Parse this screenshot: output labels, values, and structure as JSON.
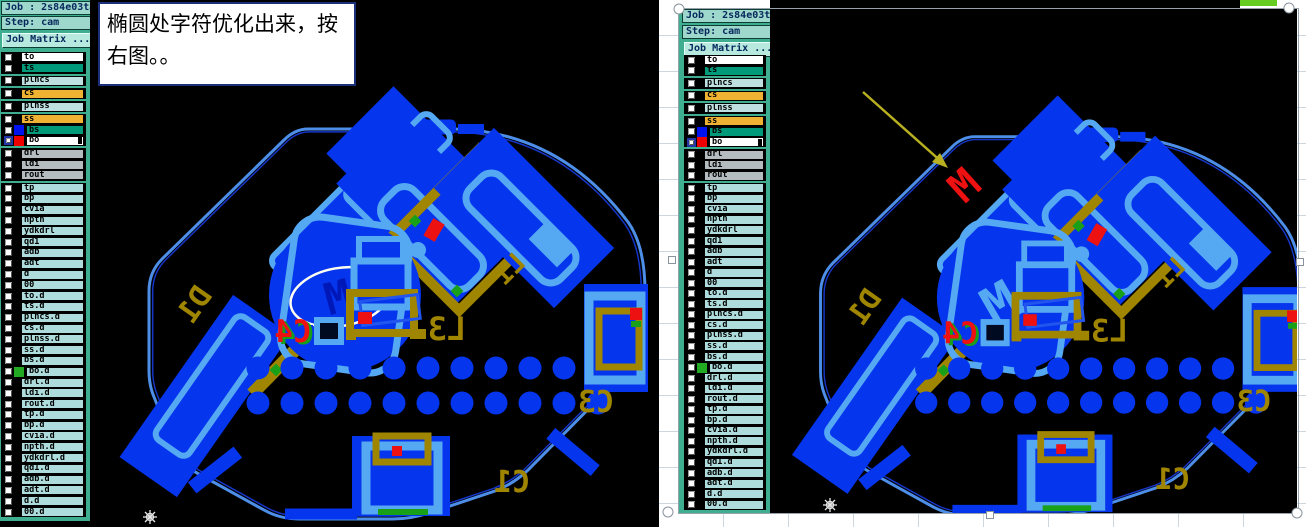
{
  "app": {
    "job_label": "Job : 2s84e03ta0",
    "step_label": "Step: cam",
    "matrix_button": "Job Matrix ..."
  },
  "annotation": {
    "text": "椭圆处字符优化出来，按右图。。"
  },
  "layers": [
    {
      "name": "to",
      "bg": "#ffffff"
    },
    {
      "name": "ts",
      "bg": "#00997a"
    },
    {
      "name": "plncs",
      "bg": "#bfe0e0",
      "gap": true
    },
    {
      "name": "cs",
      "bg": "#f0b233",
      "gap": true
    },
    {
      "name": "plnss",
      "bg": "#bfe0e0",
      "gap": true
    },
    {
      "name": "ss",
      "bg": "#f0b233",
      "gap": true
    },
    {
      "name": "bs",
      "bg": "#00997a",
      "chip": "#0013ee"
    },
    {
      "name": "bo",
      "bg": "#ffffff",
      "chip": "#ee0000",
      "selected": true,
      "notch": true
    },
    {
      "name": "drl",
      "bg": "#b4bcc0",
      "gap": true
    },
    {
      "name": "ldi",
      "bg": "#b4bcc0"
    },
    {
      "name": "rout",
      "bg": "#b4bcc0"
    },
    {
      "name": "tp",
      "bg": "#aedcdc",
      "gap": true
    },
    {
      "name": "bp",
      "bg": "#aedcdc"
    },
    {
      "name": "cvia",
      "bg": "#aedcdc"
    },
    {
      "name": "npth",
      "bg": "#aedcdc"
    },
    {
      "name": "ydkdrl",
      "bg": "#aedcdc"
    },
    {
      "name": "qd1",
      "bg": "#aedcdc"
    },
    {
      "name": "adb",
      "bg": "#aedcdc"
    },
    {
      "name": "adt",
      "bg": "#aedcdc"
    },
    {
      "name": "d",
      "bg": "#aedcdc"
    },
    {
      "name": "00",
      "bg": "#aedcdc"
    },
    {
      "name": "to.d",
      "bg": "#aedcdc"
    },
    {
      "name": "ts.d",
      "bg": "#aedcdc"
    },
    {
      "name": "plncs.d",
      "bg": "#aedcdc"
    },
    {
      "name": "cs.d",
      "bg": "#aedcdc"
    },
    {
      "name": "plnss.d",
      "bg": "#aedcdc"
    },
    {
      "name": "ss.d",
      "bg": "#aedcdc"
    },
    {
      "name": "bs.d",
      "bg": "#aedcdc"
    },
    {
      "name": "bo.d",
      "bg": "#aedcdc",
      "chip": "#22aa22"
    },
    {
      "name": "drl.d",
      "bg": "#aedcdc"
    },
    {
      "name": "ldi.d",
      "bg": "#aedcdc"
    },
    {
      "name": "rout.d",
      "bg": "#aedcdc"
    },
    {
      "name": "tp.d",
      "bg": "#aedcdc"
    },
    {
      "name": "bp.d",
      "bg": "#aedcdc"
    },
    {
      "name": "cvia.d",
      "bg": "#aedcdc"
    },
    {
      "name": "npth.d",
      "bg": "#aedcdc"
    },
    {
      "name": "ydkdrl.d",
      "bg": "#aedcdc"
    },
    {
      "name": "qd1.d",
      "bg": "#aedcdc"
    },
    {
      "name": "adb.d",
      "bg": "#aedcdc"
    },
    {
      "name": "adt.d",
      "bg": "#aedcdc"
    },
    {
      "name": "d.d",
      "bg": "#aedcdc"
    },
    {
      "name": "00.d",
      "bg": "#aedcdc"
    }
  ],
  "board": {
    "labels": {
      "d1": "D1",
      "c4": "C4",
      "l3": "L3",
      "l1": "L1",
      "c3": "C3",
      "c1": "C1"
    },
    "motor_char": "M",
    "moved_char": "M",
    "dot_rows": 2,
    "dots_per_row": 11
  },
  "colors": {
    "blue": "#0635ee",
    "light_blue": "#55a8f2",
    "gold": "#a08500",
    "red": "#ee1111",
    "green": "#18a018",
    "outline_blue": "#4d8fe8",
    "outline_inner": "#1636c8",
    "panel_teal": "#3fae90",
    "header_teal": "#9ed8cc",
    "canvas_black": "#000000",
    "arrow_olive": "#b8b020",
    "motor_char_color_left": "#0018b8",
    "ellipse_white": "#fffff0"
  }
}
